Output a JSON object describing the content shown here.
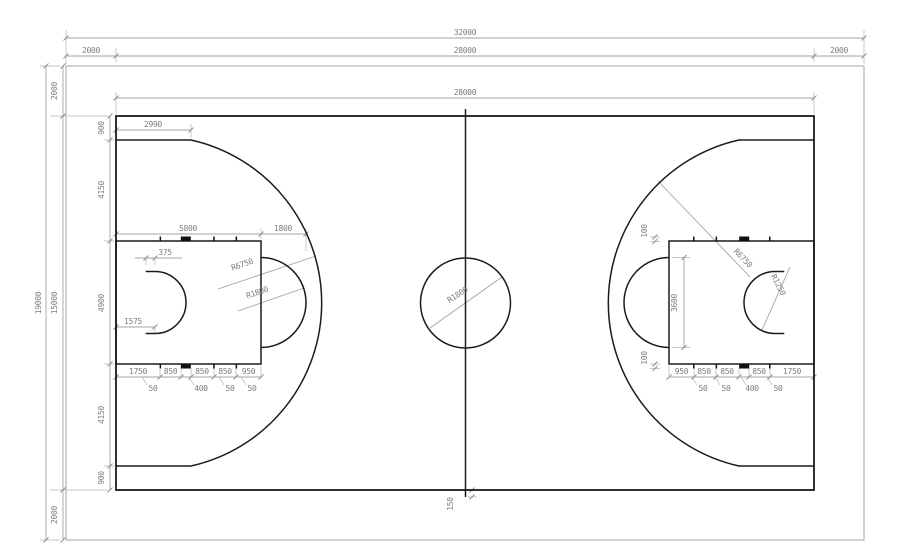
{
  "drawing": {
    "type": "basketball-court-dimensioned-plan",
    "line_color": "#1b1b1b",
    "dimension_color": "#7d7d7d"
  },
  "dims": {
    "top": {
      "overall": "32000",
      "left_margin": "2000",
      "court_length": "28000",
      "right_margin": "2000",
      "inner_court_length": "28000"
    },
    "left": {
      "overall": "19000",
      "top_margin": "2000",
      "court_width": "15000",
      "bottom_margin": "2000",
      "chain": [
        "900",
        "4150",
        "4900",
        "4150",
        "900"
      ]
    },
    "left_zone": {
      "corner_to_arc": "2990",
      "key_length": "5800",
      "ft_circle_extension": "1800",
      "restricted_straight": "375",
      "three_point_radius": "R6750",
      "ft_circle_radius": "R1800",
      "basket_offset": "1575",
      "lane_chain": [
        "1750",
        "850",
        "850",
        "850",
        "950"
      ],
      "lane_marks": [
        "50",
        "400",
        "50",
        "50"
      ]
    },
    "center": {
      "circle_radius": "R1800",
      "line_extension": "150"
    },
    "right_zone": {
      "three_point_radius": "R6750",
      "restricted_radius": "R1250",
      "ft_circle_diameter": "3600",
      "hash_length_top": "100",
      "hash_length_bottom": "100",
      "lane_chain": [
        "950",
        "850",
        "850",
        "850",
        "1750"
      ],
      "lane_marks": [
        "50",
        "50",
        "400",
        "50"
      ]
    }
  }
}
